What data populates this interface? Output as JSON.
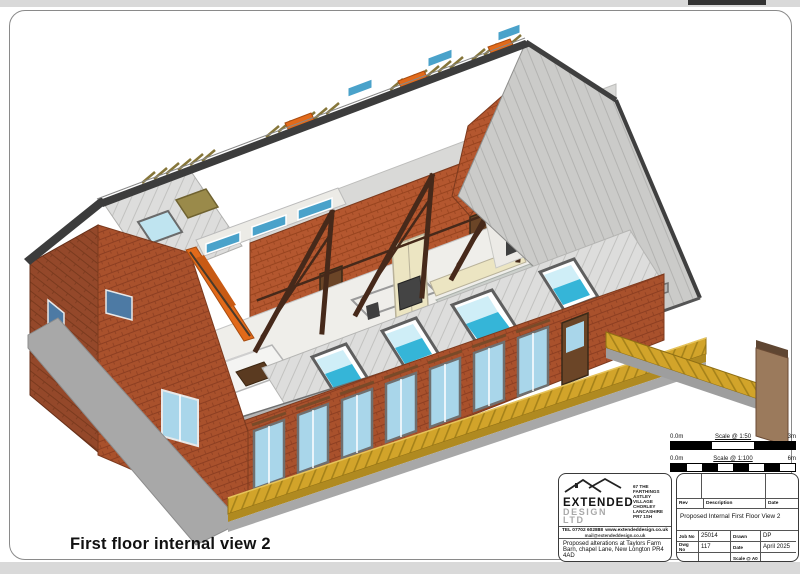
{
  "page": {
    "caption": "First floor internal view 2"
  },
  "scale_bars": [
    {
      "left_label": "0.0m",
      "title": "Scale @ 1:50",
      "right_label": "3m",
      "segments": 3
    },
    {
      "left_label": "0.0m",
      "title": "Scale @ 1:100",
      "right_label": "6m",
      "segments": 8
    }
  ],
  "title_block": {
    "company": {
      "name_line1": "EXTENDED",
      "name_line2": "DESIGN LTD",
      "address_lines": "67 THE FARTHINGS\nASTLEY VILLAGE\nCHORLEY\nLANCASHIRE\nPR7 1SH",
      "tel": "TEL 07702 602888",
      "web": "www.extendeddesign.co.uk",
      "email": "mail@extendeddesign.co.uk"
    },
    "project": "Proposed alterations at Taylors Farm Barn, chapel Lane, New Longton PR4 4AD",
    "client": "Mr & Mrs Sanderson",
    "rev_table": {
      "headers": [
        "Rev",
        "Description",
        "Date"
      ]
    },
    "drawing_title": "Proposed Internal First Floor View 2",
    "fields": [
      {
        "label": "Job No",
        "value": "25014"
      },
      {
        "label": "Drawn",
        "value": "DP"
      },
      {
        "label": "Dwg No",
        "value": "117"
      },
      {
        "label": "Date",
        "value": "April 2025"
      },
      {
        "label": "Scale @ A0",
        "value": ""
      }
    ]
  },
  "drawing": {
    "description": "3D cutaway view of barn conversion first floor interior",
    "icons": [
      "roofline-logo-icon"
    ]
  },
  "colors": {
    "chrome": "#d9d9d9",
    "chrome_accent": "#333333",
    "ridge": "#3c3c3c",
    "cap": "#b5b5b5",
    "base": "#a8a8a8",
    "floor": "#efeeea",
    "wallwhite": "#eceae6",
    "wallgrey": "#9a9a9a",
    "cream": "#ece5c2",
    "orange": "#e26a1a",
    "tan": "#9b7a5c",
    "glass": "#a9d6ea",
    "glasscyan": "#35b5d8",
    "glasslight": "#cfeef7",
    "glassdark": "#4d7aa4",
    "glassteal": "#4aa2ca",
    "truss": "#46291a",
    "brick": "#a9512c",
    "brickline": "#8d3f22",
    "brickR": "#b4572f",
    "brickRline": "#98441f",
    "brickD": "#94482a",
    "brickDline": "#7a3a1e",
    "deck": "#d2a42a",
    "deckline": "#a5821a",
    "deckfront": "#b08a20",
    "roof": "#dddddc",
    "roofline": "#c2c2c0",
    "roofR": "#cbcbc9"
  }
}
